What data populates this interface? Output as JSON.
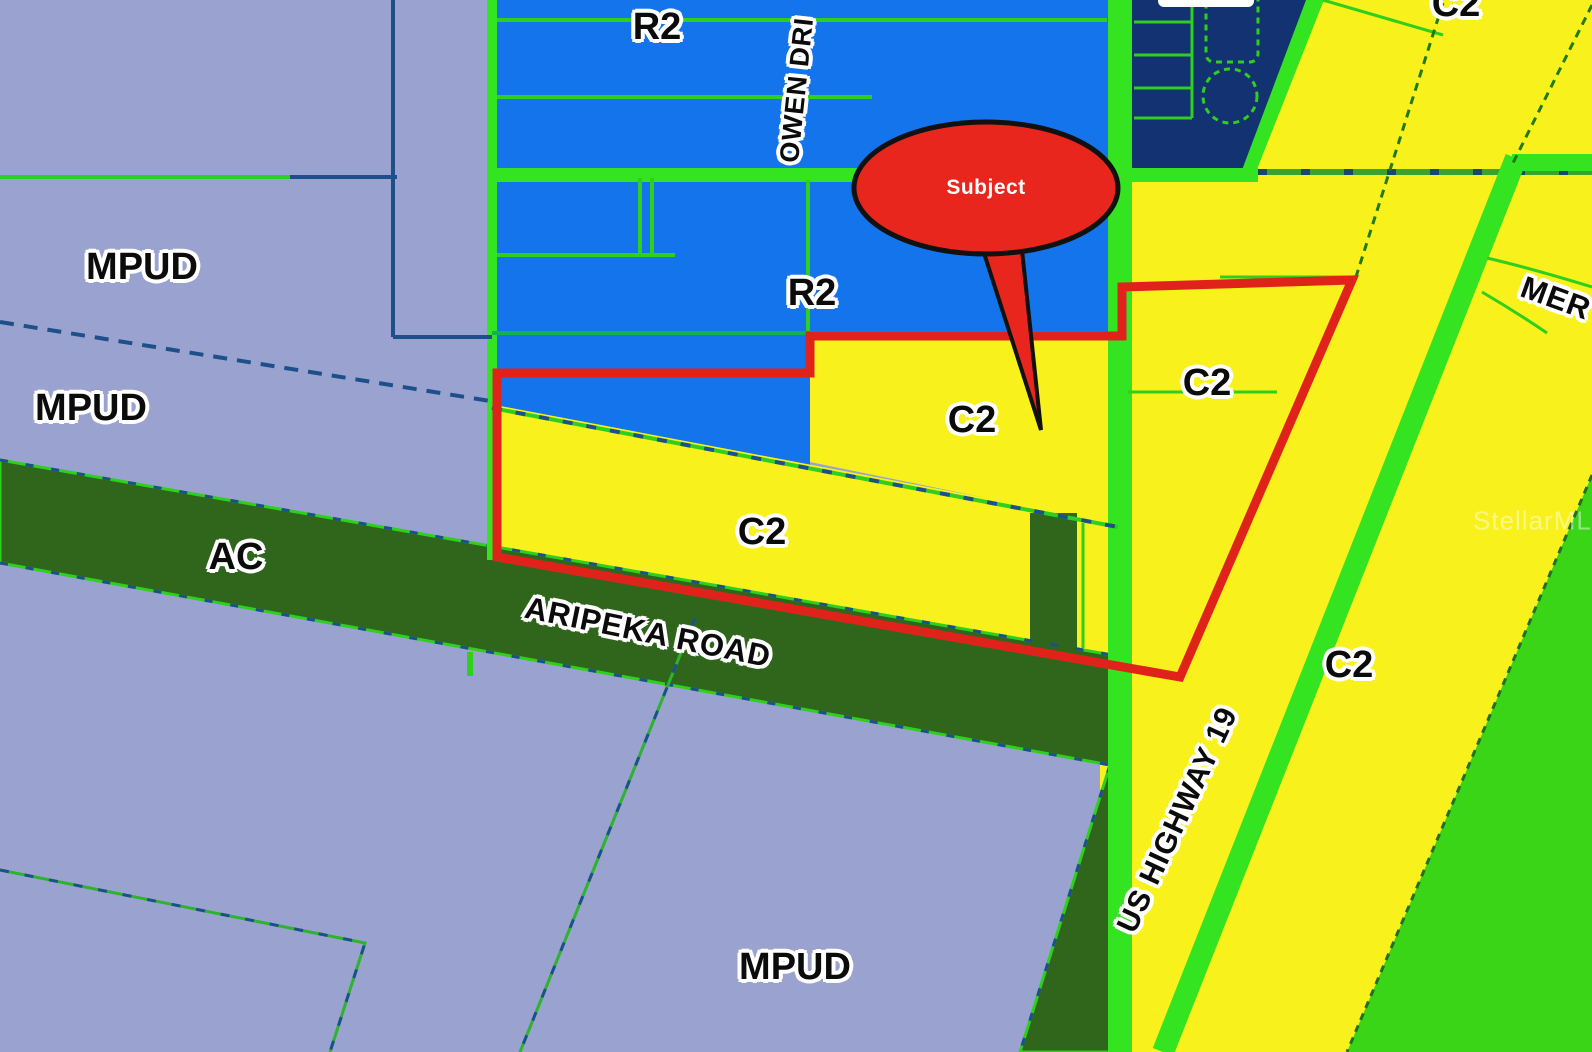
{
  "map_type": "zoning-map",
  "zones": {
    "mpud_a": "MPUD",
    "mpud_b": "MPUD",
    "mpud_c": "MPUD",
    "r2_a": "R2",
    "r2_b": "R2",
    "c2_a": "C2",
    "c2_b": "C2",
    "c2_c": "C2",
    "c2_d": "C2",
    "c2_e": "C2",
    "ac": "AC"
  },
  "streets": {
    "aripeka": "ARIPEKA ROAD",
    "owen": "OWEN DRI",
    "us19": "US HIGHWAY 19",
    "merchant": "MER"
  },
  "callout": {
    "subject": "Subject"
  },
  "watermark": "StellarMLS",
  "colors": {
    "mpud_lavender": "#9aa3cf",
    "r2_blue": "#1374ec",
    "c2_yellow": "#f9f11c",
    "ac_dark_green": "#2f661c",
    "green_zone_lime": "#3ad517",
    "navy_block": "#133271",
    "road_green": "#35e420",
    "parcel_line_green": "#2fcf1e",
    "boundary_red": "#e0231a",
    "callout_red": "#e8261d",
    "mpud_line_navy": "#1d4f8a"
  }
}
